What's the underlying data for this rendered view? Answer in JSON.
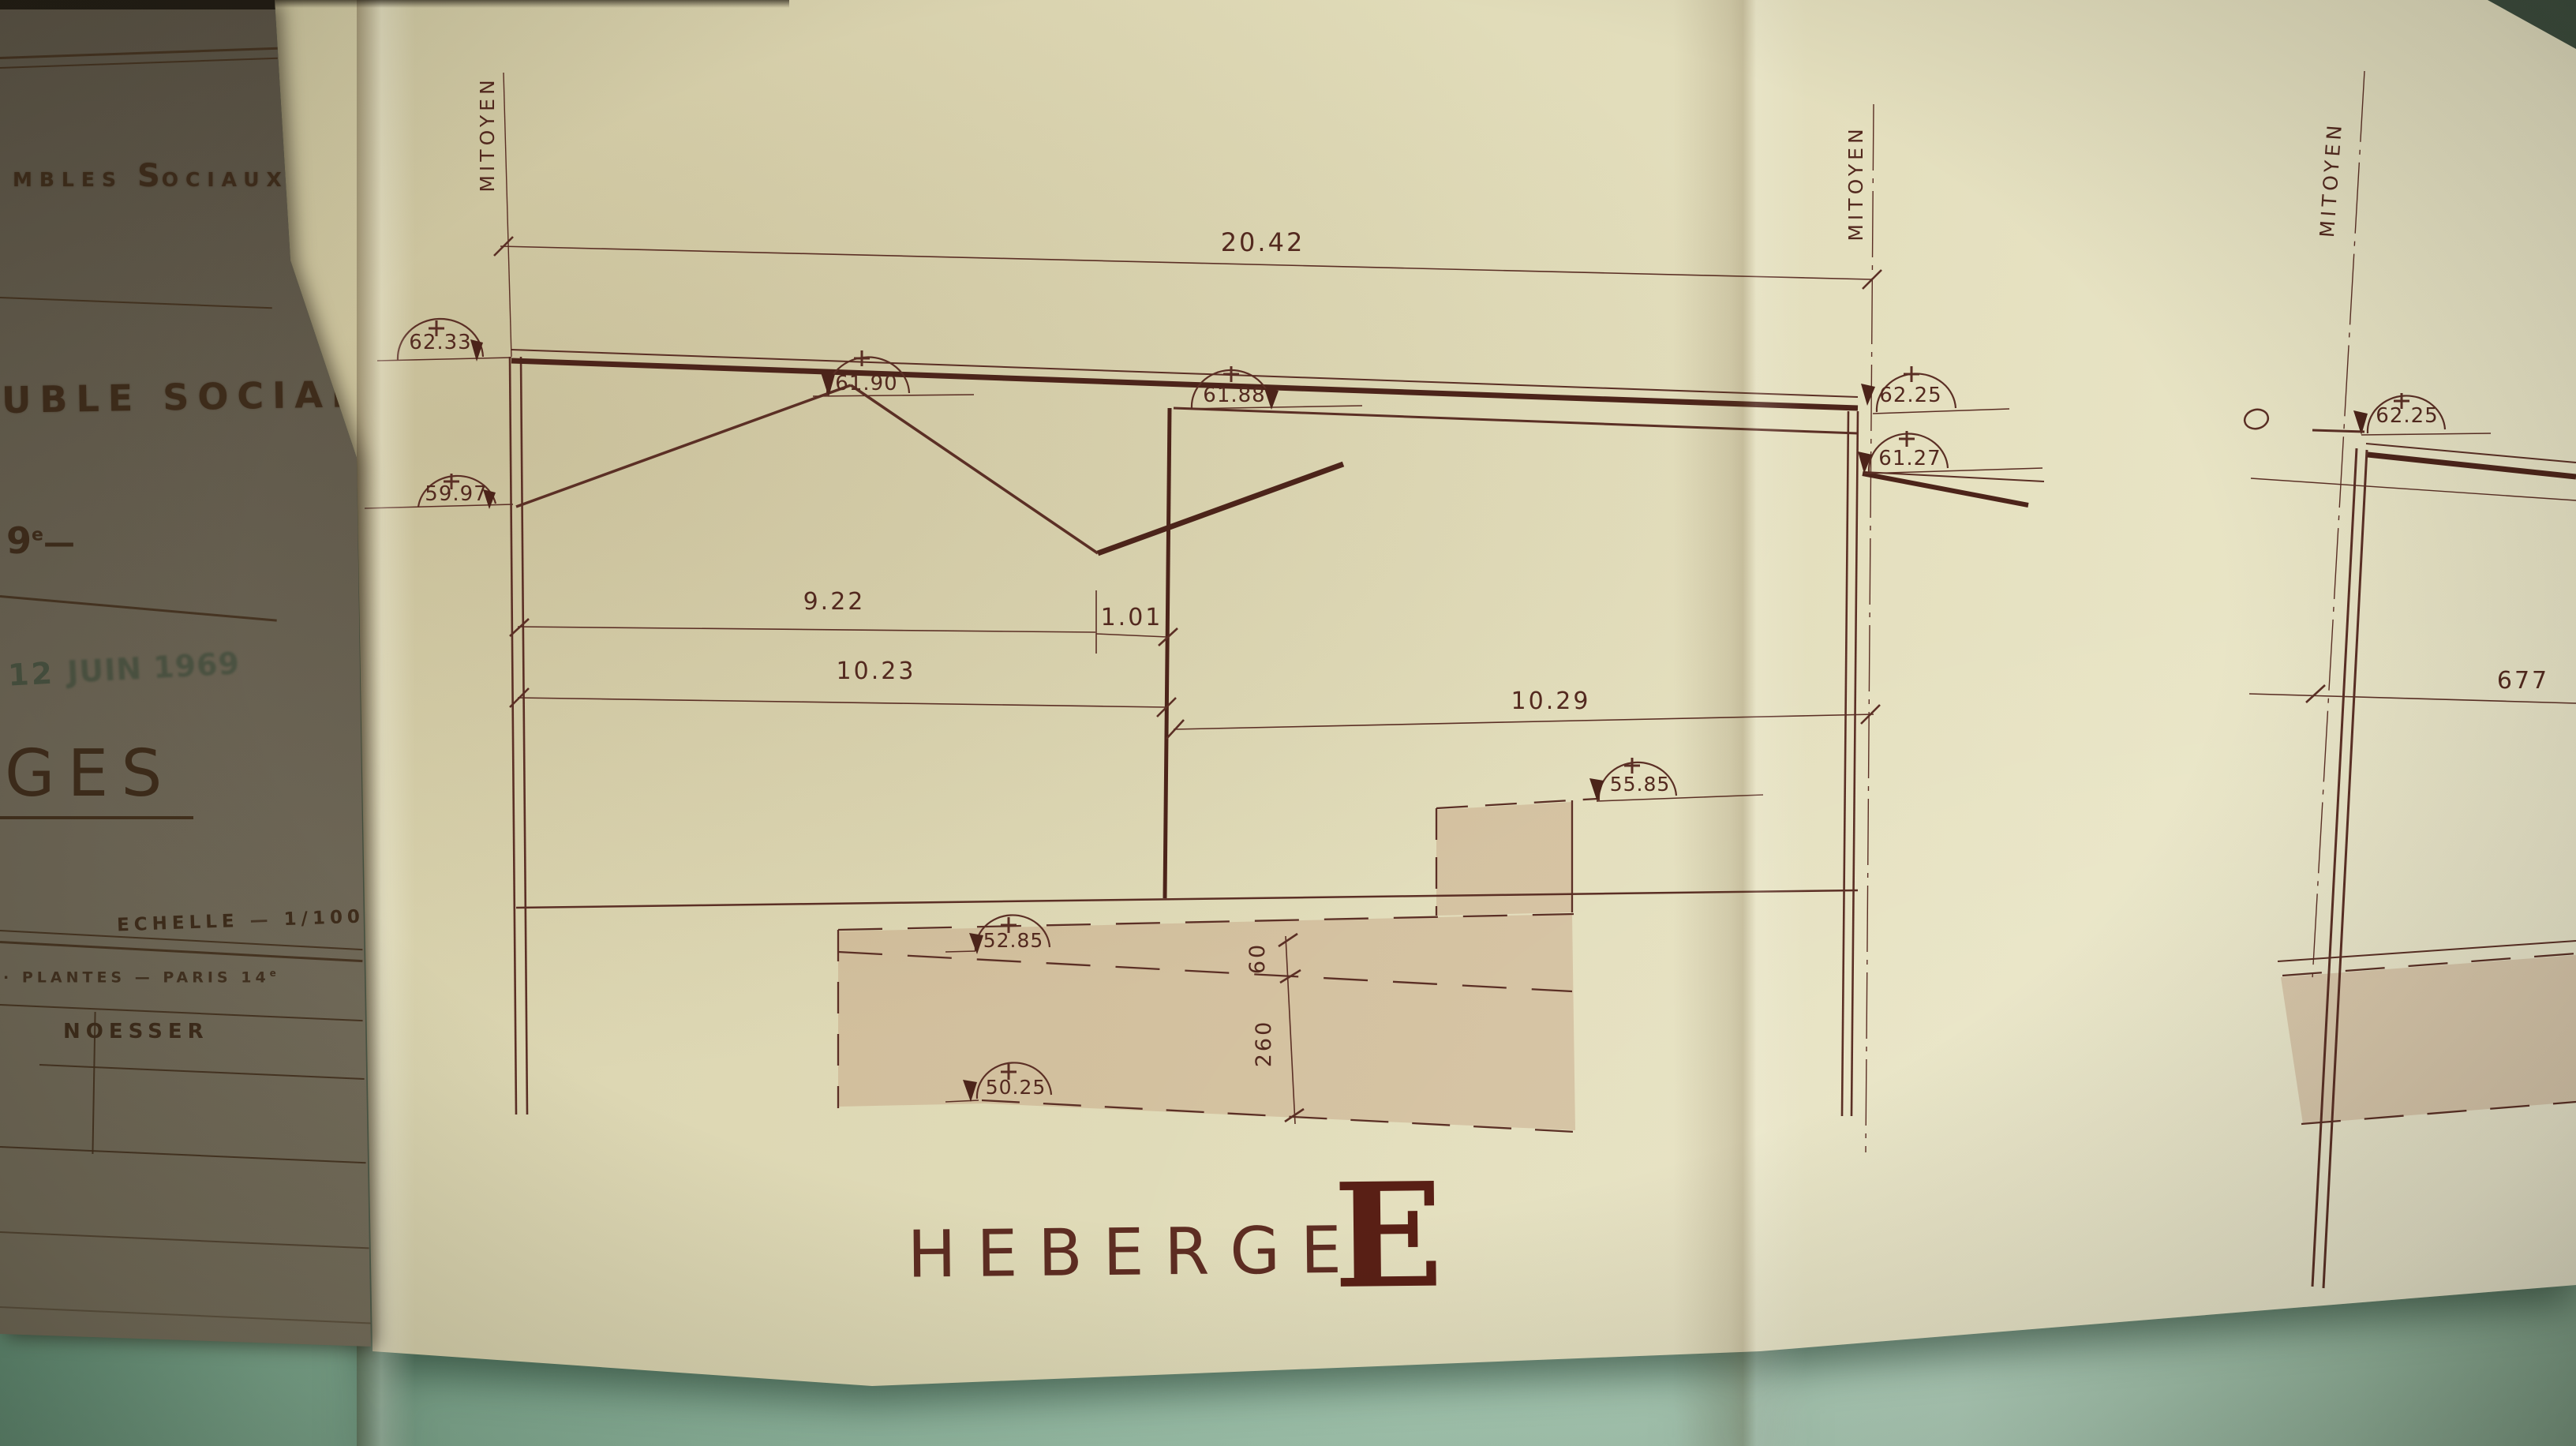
{
  "photo": {
    "subject": "photograph of a folded architectural heberge section drawing on a teal surface"
  },
  "cover_panel": {
    "social_line": {
      "before_s": "MBLES",
      "s": "S",
      "after_s": "OCIAUX"
    },
    "building_line": "UBLE SOCIAL",
    "district": {
      "number": "9",
      "sup": "e",
      "dash": "—"
    },
    "date_stamp": {
      "day": "12",
      "rest": "JUIN 1969"
    },
    "big_word_fragment": "GES",
    "scale": {
      "label": "ECHELLE",
      "sep": "—",
      "value": "1/100"
    },
    "address_line": {
      "prefix": "·",
      "text": "PLANTES — PARIS 14",
      "sup": "e"
    },
    "architect": "NOESSER"
  },
  "drawing": {
    "sheet_title": "HEBERGE",
    "sheet_letter": "E",
    "boundary_labels": {
      "left": "MITOYEN",
      "right": "MITOYEN",
      "far_right": "MITOYEN"
    },
    "dimensions": {
      "overall_width": "20.42",
      "left_roof_span": "9.22",
      "valley_offset": "1.01",
      "left_total": "10.23",
      "right_span": "10.29",
      "step_height": "60",
      "basement_height": "260",
      "far_dimension": "677"
    },
    "levels": {
      "left_parapet": "62.33",
      "left_eave": "59.97",
      "ridge": "61.90",
      "right_block_top": "61.88",
      "right_parapet": "62.25",
      "right_eave": "61.27",
      "courtyard": "55.85",
      "lower_ground": "52.85",
      "basement": "50.25",
      "far_parapet": "62.25"
    }
  }
}
